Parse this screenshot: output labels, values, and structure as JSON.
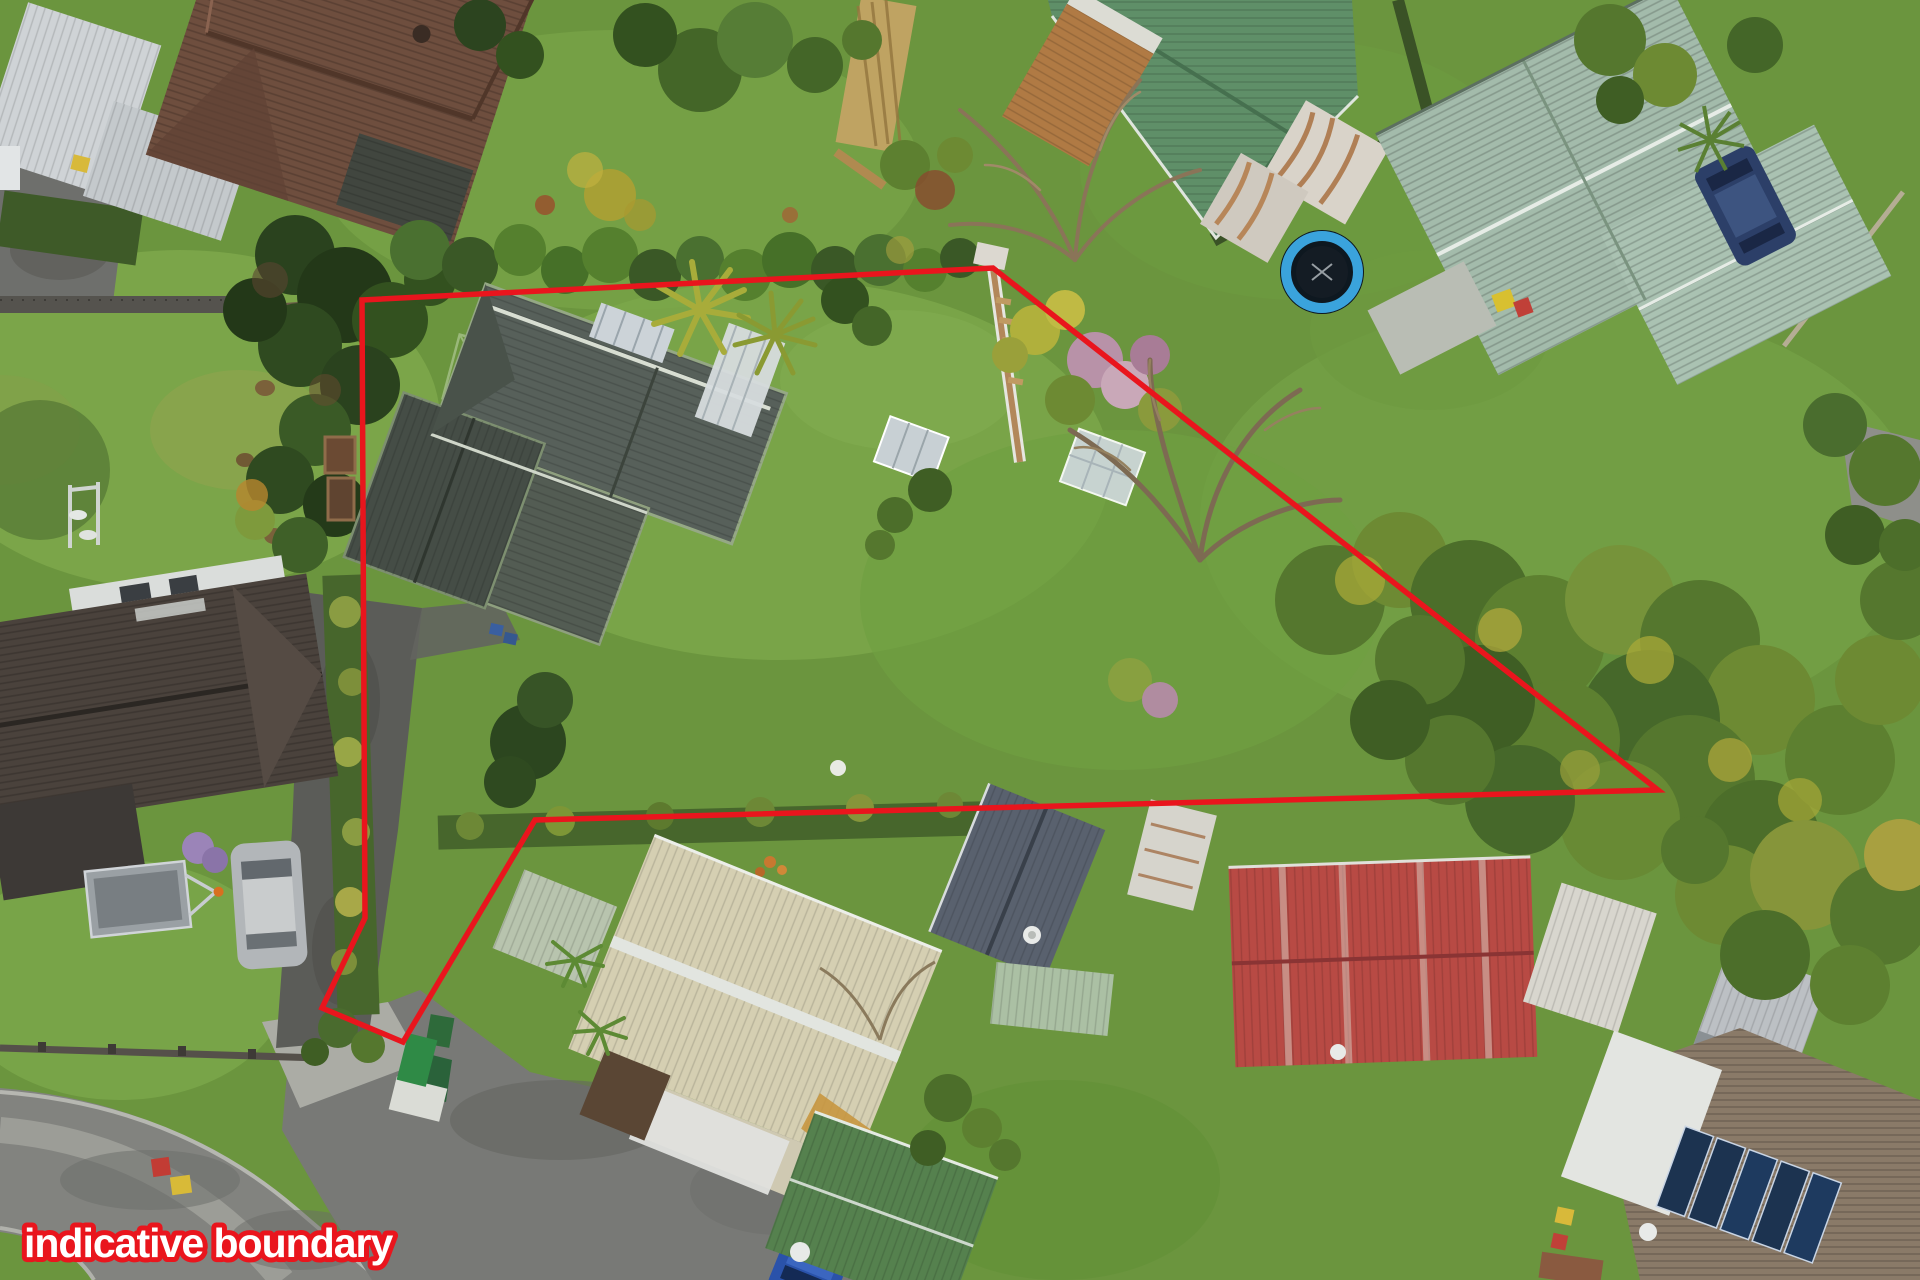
{
  "overlay": {
    "label": "indicative boundary",
    "label_text_color": "#ffffff",
    "label_outline_color": "#e9151d",
    "boundary_color": "#e9151d",
    "boundary_points": "362,300 993,268 1658,790 535,820 403,1042 322,1008 365,918"
  },
  "scene": {
    "type": "aerial-drone-photo",
    "setting": "suburban residential properties with marked section",
    "colors": {
      "grass": "#6b953e",
      "grass_light": "#7fa94c",
      "grass_dark": "#5a8634",
      "road": "#82837f",
      "asphalt_dark": "#5b5c58",
      "footpath": "#9c9d97",
      "kerb": "#b6b7b1",
      "subject_roof": "#57605a",
      "subject_roof_dark": "#454d46",
      "brown_tile_roof": "#6e4e3e",
      "dark_tile_roof": "#4a423c",
      "green_roof": "#5f8f68",
      "sage_roof": "#a3bbab",
      "cream_roof": "#d5cfb2",
      "red_roof": "#b84a44",
      "bottom_green_roof": "#55814e",
      "white_metal_roof": "#d3d6d8",
      "trampoline_ring": "#3aa3dc",
      "hedge": "#47662c"
    },
    "objects": [
      {
        "name": "boundary-overlay",
        "label": "indicative boundary"
      },
      {
        "name": "subject-house",
        "roof": "weathered dark grey corrugated hip roof"
      },
      {
        "name": "north-west-house",
        "roof": "brown tile"
      },
      {
        "name": "north-east-house",
        "roof": "green corrugated"
      },
      {
        "name": "north-east-large-house",
        "roof": "pale sage hip"
      },
      {
        "name": "south-west-house",
        "roof": "dark grey tile"
      },
      {
        "name": "south-centre-house",
        "roof": "cream corrugated"
      },
      {
        "name": "south-east-house",
        "roof": "red corrugated"
      },
      {
        "name": "trampoline",
        "color": "#3aa3dc"
      },
      {
        "name": "silver-car"
      },
      {
        "name": "blue-car"
      },
      {
        "name": "navy-car"
      },
      {
        "name": "boat-trailer"
      },
      {
        "name": "street",
        "position": "bottom-left"
      }
    ]
  }
}
